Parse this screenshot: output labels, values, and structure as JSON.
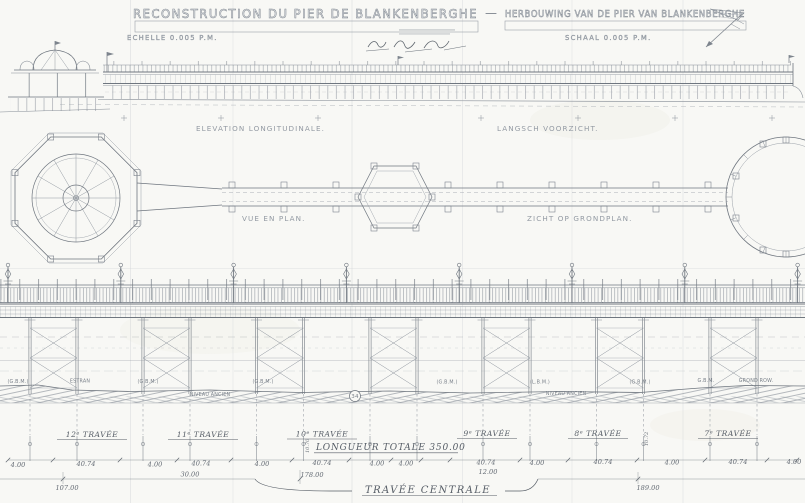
{
  "header": {
    "title_fr": "RECONSTRUCTION DU PIER DE BLANKENBERGHE",
    "separator": "—",
    "title_nl": "HERBOUWING VAN DE PIER VAN BLANKENBERGHE",
    "scale_fr": "ECHELLE 0.005 P.M.",
    "scale_nl": "SCHAAL 0.005 P.M."
  },
  "drawing_labels": {
    "elevation_fr": "ELEVATION LONGITUDINALE.",
    "elevation_nl": "LANGSCH VOORZICHT.",
    "plan_fr": "VUE EN PLAN.",
    "plan_nl": "ZICHT OP GRONDPLAN."
  },
  "ground_labels": {
    "g1": "(G.B.M.)",
    "estran": "ESTRAN",
    "g2": "(G.B.M.)",
    "g3": "(G.B.M.)",
    "g4": "(G.B.M.)",
    "g5": "(L.B.M.)",
    "g6": "(G.B.M.)",
    "g7": "G.B.M.",
    "grond": "GROND ROW.",
    "niveau1": "NIVEAU ANCIEN",
    "niveau2": "NIVEAU ANCIEN",
    "marker": "34"
  },
  "spans": {
    "t12": "12ᵉ TRAVÉE",
    "t11": "11ᵉ TRAVÉE",
    "t10": "10ᵉ TRAVÉE",
    "t9": "9ᵉ TRAVÉE",
    "t8": "8ᵉ TRAVÉE",
    "t7": "7ᵉ TRAVÉE",
    "longueur_totale": "LONGUEUR TOTALE  350.00",
    "travee_centrale": "TRAVÉE CENTRALE"
  },
  "dimensions": {
    "row": [
      "4.00",
      "40.74",
      "4.00",
      "40.74",
      "4.00",
      "40.74",
      "4.00",
      "4.00",
      "40.74",
      "4.00",
      "40.74",
      "4.00",
      "40.74",
      "4.00"
    ],
    "d_30": "30.00",
    "d_107": "107.00",
    "d_178": "178.00",
    "d_12": "12.00",
    "d_189": "189.00",
    "lev_a": "10.70",
    "lev_b": "10.72"
  }
}
